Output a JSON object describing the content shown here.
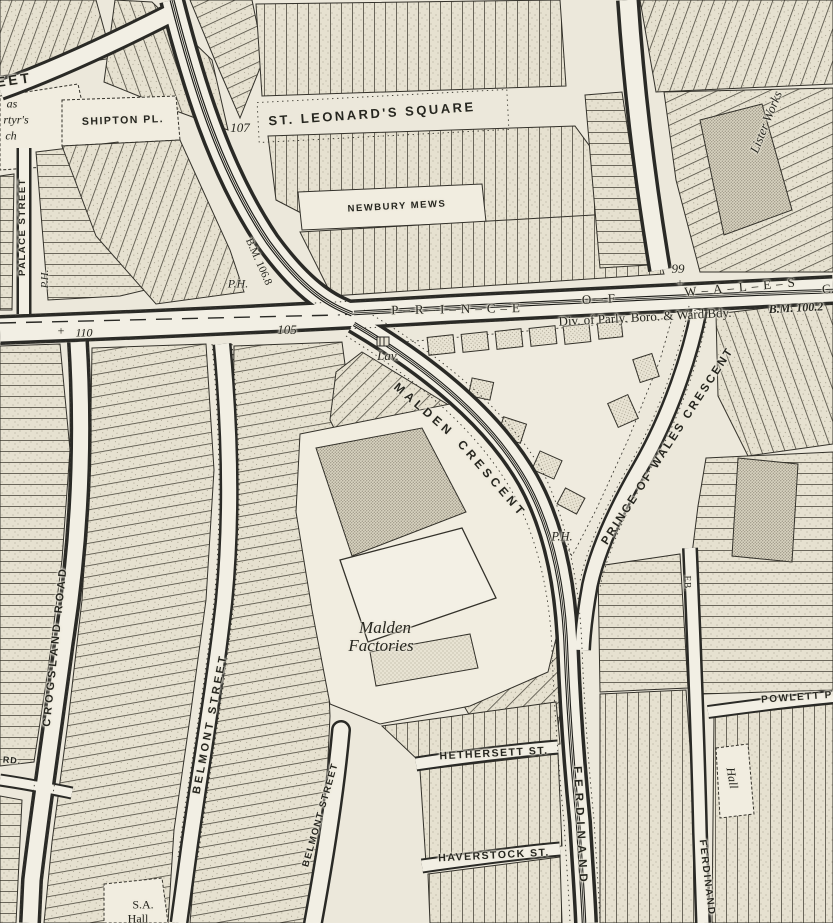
{
  "map_type": "historic-ordnance-survey-town-plan",
  "palette": {
    "paper": "#ece8db",
    "ink": "#2a2a26",
    "building_stipple": "#97917f",
    "dense_stipple": "#6f695a",
    "court_white": "#f1ede0"
  },
  "labels": {
    "street_fragment_eet": "EET",
    "church_frag_1": "as",
    "church_frag_2": "rtyr's",
    "church_frag_3": "ch",
    "shipton_place": "SHIPTON PL.",
    "spot_107": "107",
    "st_leonards_square": "ST. LEONARD'S SQUARE",
    "newbury_mews": "NEWBURY MEWS",
    "lister_works": "Lister Works",
    "palace_street": "PALACE STREET",
    "ph_palace": "P.H.",
    "ph_junction": "P.H.",
    "ph_malden": "P.H.",
    "bm_106_8": "B.M. 106.8",
    "plus_110": "+",
    "spot_110": "110",
    "spot_105": "105",
    "road_prince": "P–R–I–N–C–E",
    "road_of": "O–F",
    "road_wales": "W–A–L–E–S",
    "road_c_frag": "C.",
    "spot_99": "99",
    "plus_99": "+",
    "boundary_text": "Div. of Parly. Boro. & Ward Bdy.",
    "bm_100_2": "B.M. 100.2",
    "lavatory": "Lav.",
    "malden_word": "MALDEN",
    "crescent_word": "CRESCENT",
    "prince_of_wales_crescent": "PRINCE OF WALES CRESCENT",
    "crogsland_road": "CROGSLAND ROAD",
    "belmont_street_1": "BELMONT STREET",
    "belmont_street_2": "BELMONT STREET",
    "malden_factories_1": "Malden",
    "malden_factories_2": "Factories",
    "hethersett_st": "HETHERSETT ST.",
    "haverstock_st": "HAVERSTOCK ST.",
    "ferdinand_1": "FERDINAND",
    "ferdinand_2": "FERDINAND",
    "powlett_place": "POWLETT PL.",
    "hall_right": "Hall",
    "fb": "F.B.",
    "sa_hall_1": "S.A.",
    "sa_hall_2": "Hall",
    "rd_fragment": "RD."
  }
}
